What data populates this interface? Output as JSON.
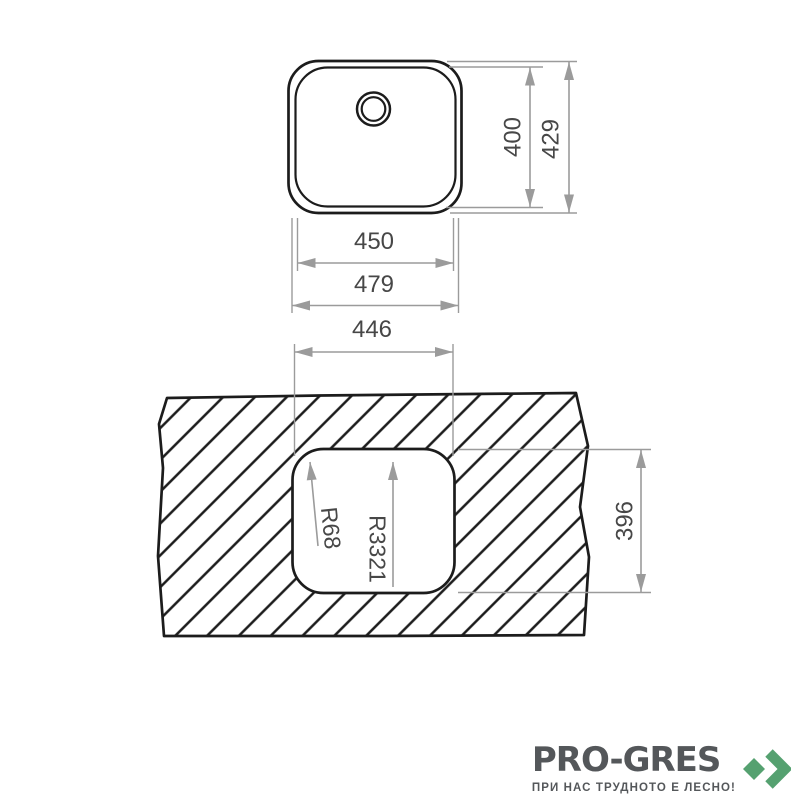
{
  "drawing": {
    "top_view": {
      "bowl_height": "400",
      "outer_height": "429",
      "bowl_width": "450",
      "outer_width": "479"
    },
    "cutout_view": {
      "cutout_width": "446",
      "cutout_height": "396",
      "corner_radius": "R68",
      "edge_radius": "R3321"
    }
  },
  "logo": {
    "brand": "PRO-GRES",
    "tagline": "ПРИ НАС ТРУДНОТО Е ЛЕСНО!"
  },
  "colors": {
    "drawing_line": "#1c1c1c",
    "dimension_line": "#9b9b9b",
    "dimension_text": "#474747",
    "logo_text": "#54575a",
    "logo_green": "#55a170",
    "background": "#ffffff"
  }
}
